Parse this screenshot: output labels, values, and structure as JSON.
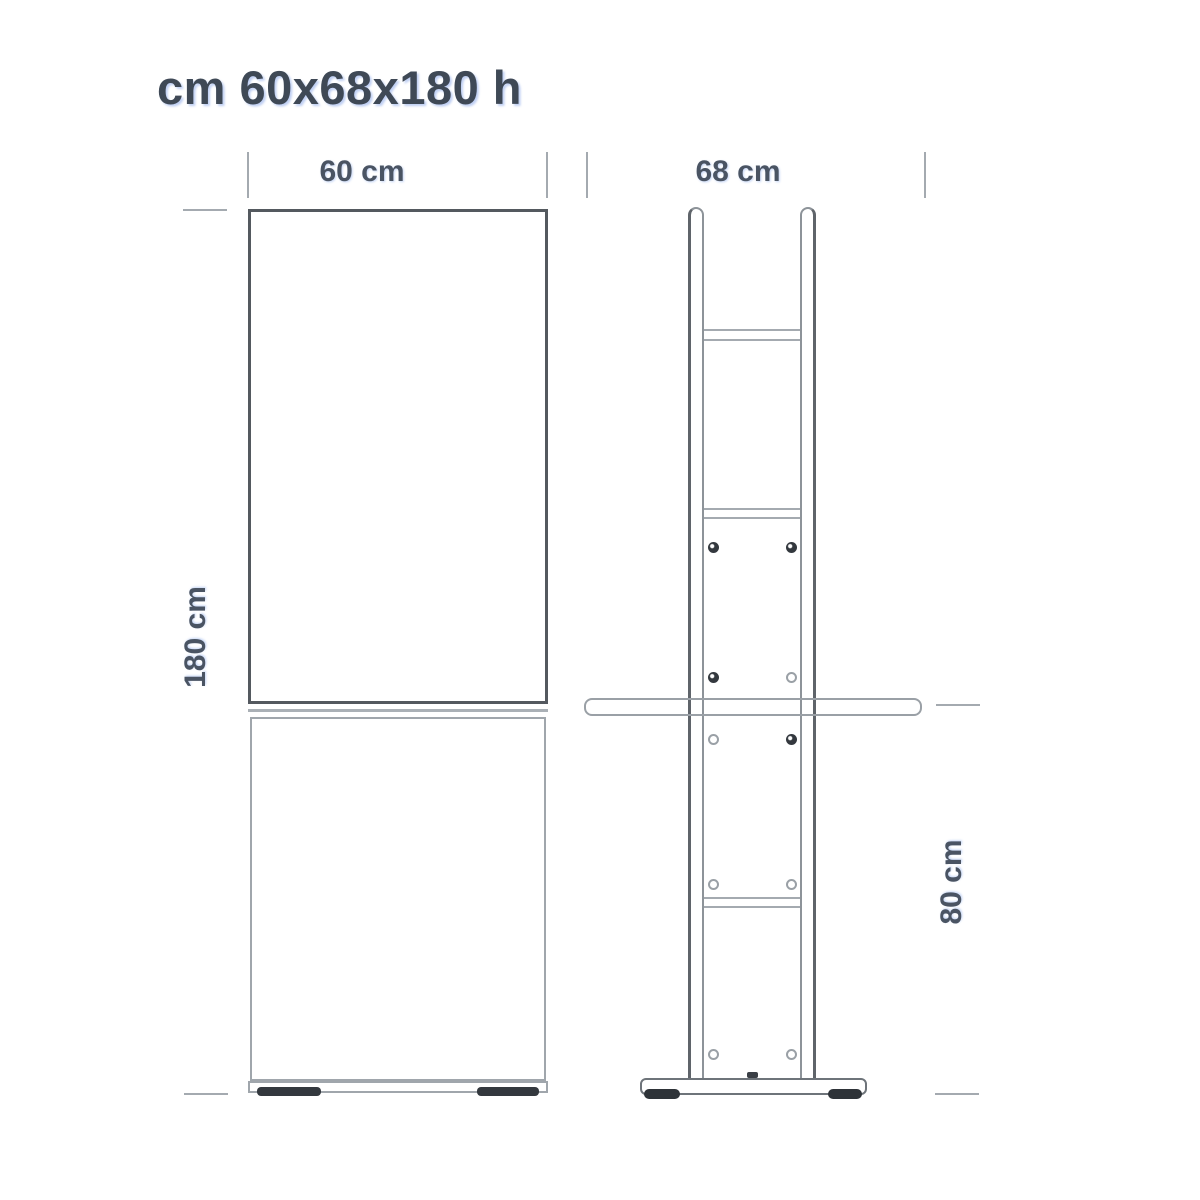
{
  "title": "cm 60x68x180 h",
  "dimensions": {
    "width": {
      "label": "60 cm",
      "value_cm": 60
    },
    "depth": {
      "label": "68 cm",
      "value_cm": 68
    },
    "height": {
      "label": "180 cm",
      "value_cm": 180
    },
    "shelf_height": {
      "label": "80 cm",
      "value_cm": 80
    }
  },
  "colors": {
    "background": "#ffffff",
    "line_light": "#9aa0a6",
    "line_dark": "#54595f",
    "label_text": "#4a5463",
    "screw_dark": "#33383e"
  }
}
